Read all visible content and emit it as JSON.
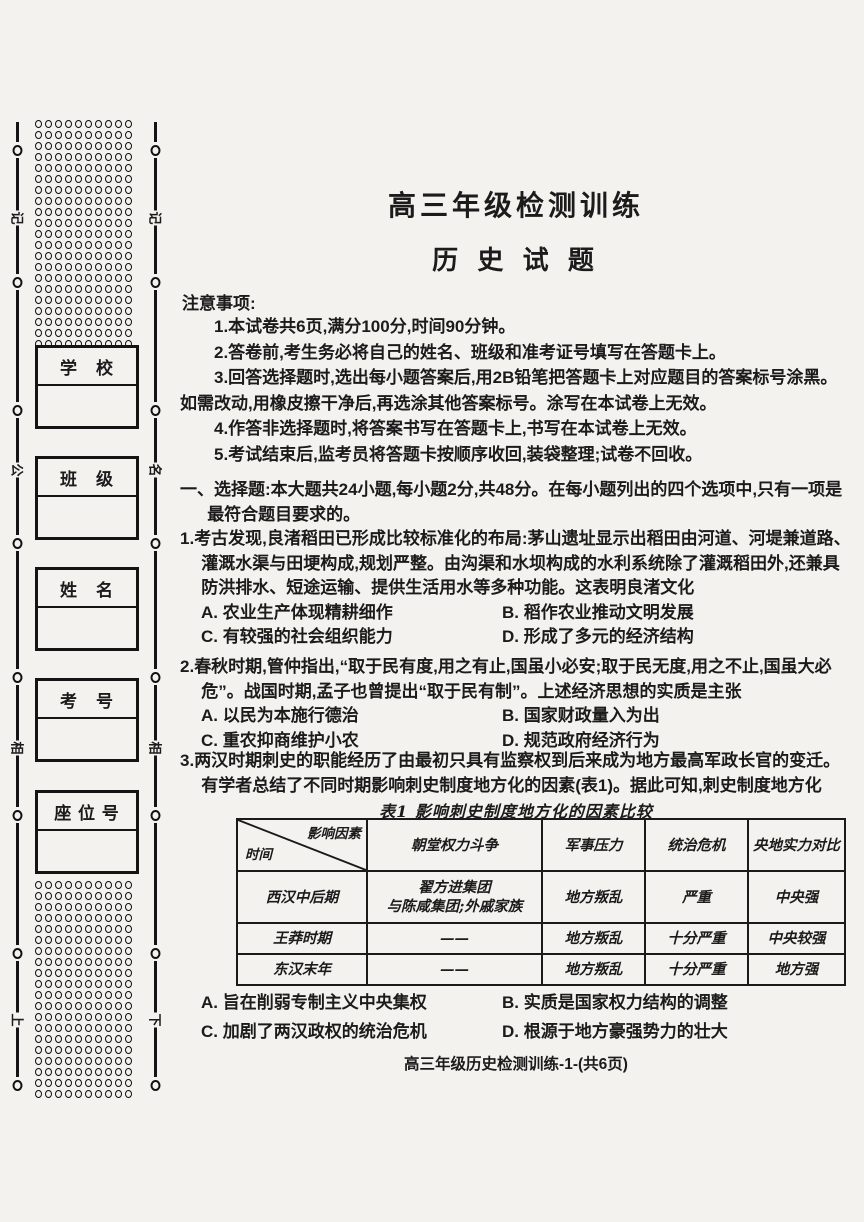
{
  "page": {
    "title_line1": "高三年级检测训练",
    "title_line2": "历 史 试 题",
    "footer": "高三年级历史检测训练-1-(共6页)"
  },
  "sidebar": {
    "boxes": [
      {
        "label": "学　校"
      },
      {
        "label": "班　级"
      },
      {
        "label": "姓　名"
      },
      {
        "label": "考　号"
      },
      {
        "label": "座 位 号"
      }
    ],
    "seal_marks": {
      "left": [
        "记",
        "公",
        "相",
        "上"
      ],
      "right": [
        "记",
        "名",
        "相",
        "下"
      ]
    },
    "grids": {
      "top": {
        "rows": 21,
        "cols": 10
      },
      "bottom": {
        "rows": 20,
        "cols": 10
      }
    }
  },
  "notice": {
    "heading": "注意事项:",
    "items": [
      "1.本试卷共6页,满分100分,时间90分钟。",
      "2.答卷前,考生务必将自己的姓名、班级和准考证号填写在答题卡上。",
      "3.回答选择题时,选出每小题答案后,用2B铅笔把答题卡上对应题目的答案标号涂黑。如需改动,用橡皮擦干净后,再选涂其他答案标号。涂写在本试卷上无效。",
      "4.作答非选择题时,将答案书写在答题卡上,书写在本试卷上无效。",
      "5.考试结束后,监考员将答题卡按顺序收回,装袋整理;试卷不回收。"
    ]
  },
  "section1": {
    "heading": "一、选择题:本大题共24小题,每小题2分,共48分。在每小题列出的四个选项中,只有一项是最符合题目要求的。"
  },
  "questions": [
    {
      "number": "1.",
      "stem": "考古发现,良渚稻田已形成比较标准化的布局:茅山遗址显示出稻田由河道、河堤兼道路、灌溉水渠与田埂构成,规划严整。由沟渠和水坝构成的水利系统除了灌溉稻田外,还兼具防洪排水、短途运输、提供生活用水等多种功能。这表明良渚文化",
      "options": [
        "A. 农业生产体现精耕细作",
        "B. 稻作农业推动文明发展",
        "C. 有较强的社会组织能力",
        "D. 形成了多元的经济结构"
      ]
    },
    {
      "number": "2.",
      "stem": "春秋时期,管仲指出,“取于民有度,用之有止,国虽小必安;取于民无度,用之不止,国虽大必危”。战国时期,孟子也曾提出“取于民有制”。上述经济思想的实质是主张",
      "options": [
        "A. 以民为本施行德治",
        "B. 国家财政量入为出",
        "C. 重农抑商维护小农",
        "D. 规范政府经济行为"
      ]
    },
    {
      "number": "3.",
      "stem": "两汉时期刺史的职能经历了由最初只具有监察权到后来成为地方最高军政长官的变迁。有学者总结了不同时期影响刺史制度地方化的因素(表1)。据此可知,刺史制度地方化",
      "options": [
        "A. 旨在削弱专制主义中央集权",
        "B. 实质是国家权力结构的调整",
        "C. 加剧了两汉政权的统治危机",
        "D. 根源于地方豪强势力的壮大"
      ]
    }
  ],
  "table": {
    "caption": "表1  影响刺史制度地方化的因素比较",
    "corner": {
      "top": "影响因素",
      "bottom": "时间"
    },
    "columns": [
      "朝堂权力斗争",
      "军事压力",
      "统治危机",
      "央地实力对比"
    ],
    "rows": [
      {
        "period": "西汉中后期",
        "c1a": "翟方进集团",
        "c1b": "与陈咸集团;外戚家族",
        "c2": "地方叛乱",
        "c3": "严重",
        "c4": "中央强"
      },
      {
        "period": "王莽时期",
        "c1a": "——",
        "c1b": "",
        "c2": "地方叛乱",
        "c3": "十分严重",
        "c4": "中央较强"
      },
      {
        "period": "东汉末年",
        "c1a": "——",
        "c1b": "",
        "c2": "地方叛乱",
        "c3": "十分严重",
        "c4": "地方强"
      }
    ]
  }
}
